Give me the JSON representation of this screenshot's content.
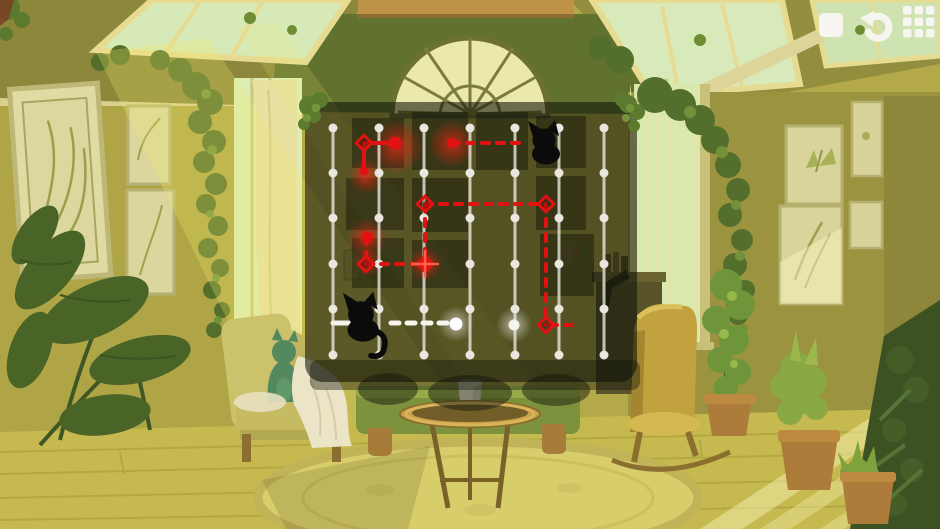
{
  "toolbar": {
    "buttons": [
      {
        "id": "square",
        "icon": "square-icon"
      },
      {
        "id": "undo",
        "icon": "undo-icon"
      },
      {
        "id": "levels",
        "icon": "grid-menu-icon"
      }
    ],
    "icon_color": "#f6f5ef"
  },
  "palette": {
    "path_red": "#e31212",
    "path_white": "#f4f3ec",
    "grid_line": "rgba(235,234,226,0.78)",
    "grid_dot": "#e9e7df",
    "board_overlay": "rgba(16,19,8,0.58)",
    "cat_black": "#0b0b0b"
  },
  "board": {
    "x": 305,
    "y": 102,
    "width": 332,
    "height": 280,
    "corner_radius": 18,
    "background": "rgba(16,19,8,0.58)",
    "grid": {
      "columns_x": [
        333,
        379,
        424,
        470,
        515,
        559,
        604
      ],
      "rows_y": [
        128,
        173,
        218,
        264,
        309,
        355
      ],
      "line_color": "rgba(235,234,226,0.78)",
      "line_width": 3,
      "dot_color": "#e9e7df",
      "dot_radius": 4.5
    },
    "red_path": {
      "color": "#e31212",
      "stroke_width": 4,
      "dash": "7 8",
      "segments": [
        {
          "x1": 364,
          "y1": 143,
          "x2": 395,
          "y2": 143,
          "style": "solid"
        },
        {
          "x1": 364,
          "y1": 143,
          "x2": 364,
          "y2": 170,
          "style": "solid"
        },
        {
          "x1": 452,
          "y1": 143,
          "x2": 527,
          "y2": 143,
          "style": "dashed"
        },
        {
          "x1": 425,
          "y1": 204,
          "x2": 546,
          "y2": 204,
          "style": "dashed"
        },
        {
          "x1": 546,
          "y1": 204,
          "x2": 546,
          "y2": 325,
          "style": "dashed"
        },
        {
          "x1": 425,
          "y1": 204,
          "x2": 425,
          "y2": 264,
          "style": "dashed"
        },
        {
          "x1": 550,
          "y1": 325,
          "x2": 580,
          "y2": 325,
          "style": "dashed"
        },
        {
          "x1": 367,
          "y1": 237,
          "x2": 366,
          "y2": 264,
          "style": "dashed"
        },
        {
          "x1": 366,
          "y1": 264,
          "x2": 425,
          "y2": 264,
          "style": "dashed"
        }
      ],
      "diamond_nodes": [
        {
          "x": 364,
          "y": 143,
          "filled": false
        },
        {
          "x": 425,
          "y": 204,
          "filled": false
        },
        {
          "x": 546,
          "y": 204,
          "filled": false
        },
        {
          "x": 546,
          "y": 325,
          "filled": false
        },
        {
          "x": 366,
          "y": 264,
          "filled": false
        },
        {
          "x": 425,
          "y": 264,
          "filled": true
        }
      ],
      "dots": [
        {
          "x": 395,
          "y": 143,
          "r": 6.5
        },
        {
          "x": 364,
          "y": 171,
          "r": 4.5
        },
        {
          "x": 452,
          "y": 143,
          "r": 5
        },
        {
          "x": 367,
          "y": 237,
          "r": 6
        }
      ],
      "glows": [
        {
          "x": 397,
          "y": 147,
          "r": 27
        },
        {
          "x": 452,
          "y": 144,
          "r": 24
        },
        {
          "x": 366,
          "y": 176,
          "r": 18
        },
        {
          "x": 367,
          "y": 238,
          "r": 20
        },
        {
          "x": 368,
          "y": 262,
          "r": 14
        },
        {
          "x": 425,
          "y": 264,
          "r": 17
        }
      ]
    },
    "white_path": {
      "color": "#f4f3ec",
      "stroke_width": 5,
      "dash": "8 8",
      "segments": [
        {
          "x1": 333,
          "y1": 323,
          "x2": 352,
          "y2": 323,
          "style": "solid"
        },
        {
          "x1": 391,
          "y1": 323,
          "x2": 448,
          "y2": 323,
          "style": "dashed"
        }
      ],
      "endpoint": {
        "x": 456,
        "y": 324,
        "r": 6.5
      },
      "highlights": [
        {
          "x": 456,
          "y": 324,
          "r": 18
        },
        {
          "x": 514,
          "y": 325,
          "r": 18
        }
      ],
      "extra_dots": [
        {
          "x": 514,
          "y": 325,
          "r": 5.5
        }
      ]
    },
    "cats": [
      {
        "x": 545,
        "y": 147,
        "scale": 1.0,
        "tail": false
      },
      {
        "x": 362,
        "y": 322,
        "scale": 1.12,
        "tail": true
      }
    ],
    "cat_color": "#0b0b0b"
  }
}
